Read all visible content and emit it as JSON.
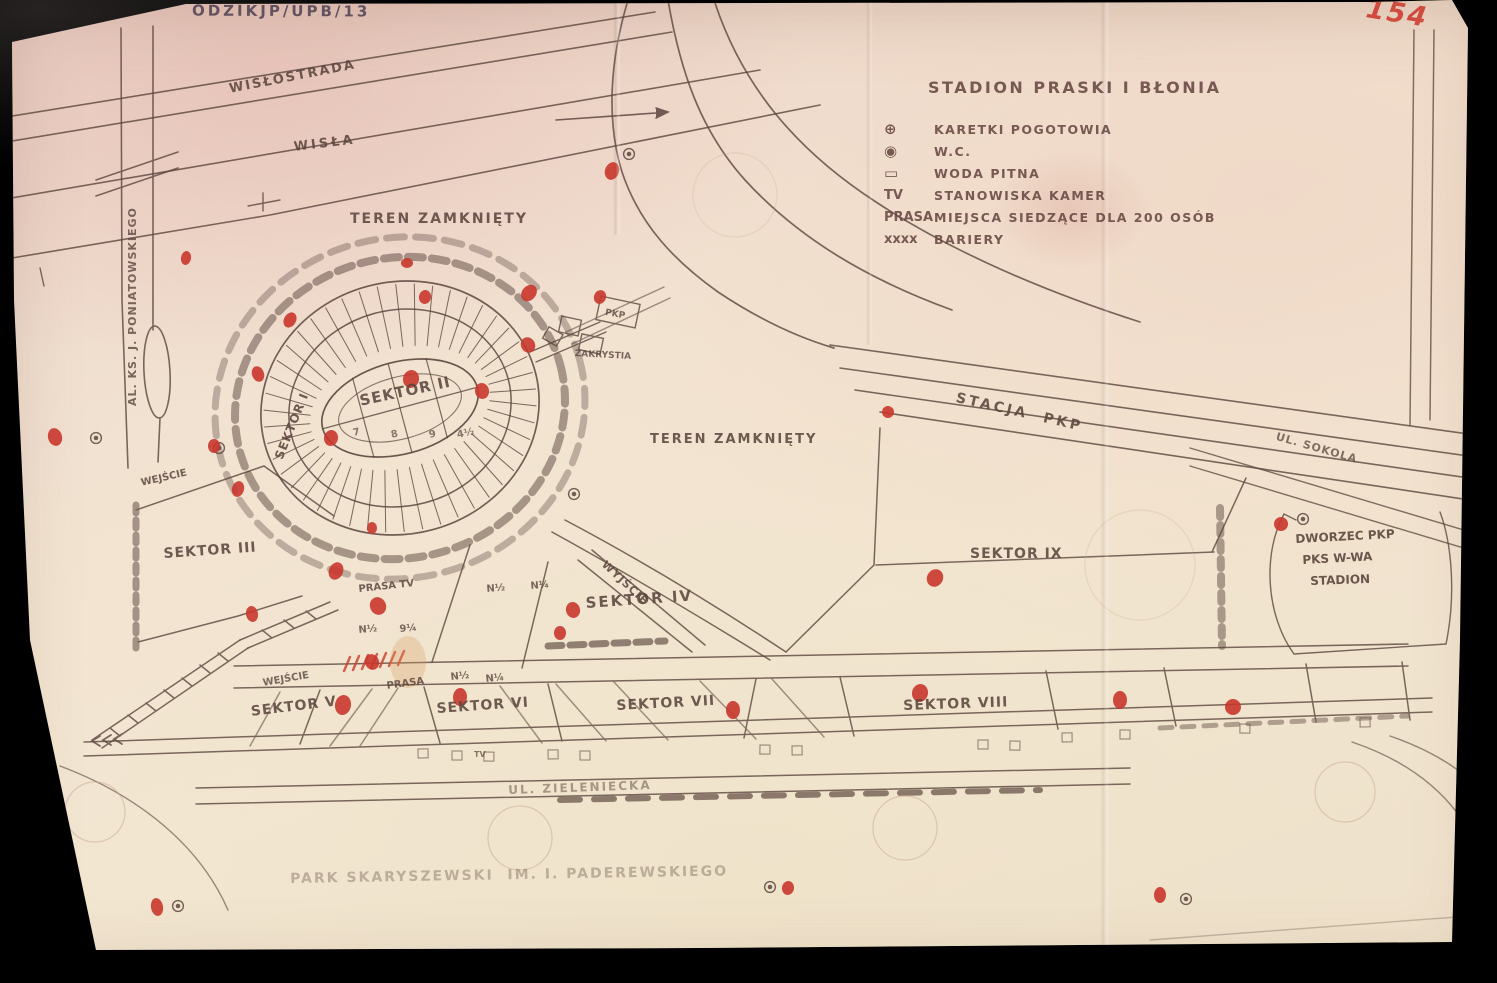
{
  "document": {
    "code": "ODZIKJP/UPB/13",
    "page_number": "154",
    "title": "STADION PRASKI I BŁONIA"
  },
  "legend": {
    "items": [
      {
        "icon": "ambulance-circle-icon",
        "symbol": "⊕",
        "label": "KARETKI POGOTOWIA"
      },
      {
        "icon": "wc-circle-icon",
        "symbol": "◉",
        "label": "W.C."
      },
      {
        "icon": "drinking-water-icon",
        "symbol": "▭",
        "label": "WODA PITNA"
      },
      {
        "icon": "tv-marker",
        "symbol": "TV",
        "label": "STANOWISKA KAMER"
      },
      {
        "icon": "press-marker",
        "symbol": "PRASA",
        "label": "MIEJSCA SIEDZĄCE DLA 200 OSÓB"
      },
      {
        "icon": "barrier-marker",
        "symbol": "xxxx",
        "label": "BARIERY"
      }
    ]
  },
  "map": {
    "colors": {
      "paper": "#f0e1d0",
      "ink": "#5c463e",
      "red": "#c9362c"
    },
    "labels": [
      {
        "name": "wislostrada",
        "text": "WISŁOSTRADA",
        "x": 228,
        "y": 82,
        "fs": 13,
        "rot": -11,
        "ls": 2
      },
      {
        "name": "wisla",
        "text": "WISŁA",
        "x": 293,
        "y": 140,
        "fs": 13,
        "rot": -7,
        "ls": 3
      },
      {
        "name": "teren-zamkniety-nw",
        "text": "TEREN ZAMKNIĘTY",
        "x": 350,
        "y": 211,
        "fs": 14,
        "rot": 0,
        "ls": 2
      },
      {
        "name": "teren-zamkniety-e",
        "text": "TEREN ZAMKNIĘTY",
        "x": 650,
        "y": 432,
        "fs": 13,
        "rot": 0,
        "ls": 2
      },
      {
        "name": "sektor-i",
        "text": "SEKTOR I",
        "x": 272,
        "y": 456,
        "fs": 12,
        "rot": -68,
        "ls": 1
      },
      {
        "name": "sektor-ii",
        "text": "SEKTOR II",
        "x": 358,
        "y": 392,
        "fs": 15,
        "rot": -12,
        "ls": 1
      },
      {
        "name": "sektor-iii",
        "text": "SEKTOR III",
        "x": 163,
        "y": 546,
        "fs": 14,
        "rot": -4,
        "ls": 1
      },
      {
        "name": "sektor-iv",
        "text": "SEKTOR IV",
        "x": 585,
        "y": 594,
        "fs": 15,
        "rot": -4,
        "ls": 2
      },
      {
        "name": "sektor-v",
        "text": "SEKTOR V",
        "x": 250,
        "y": 704,
        "fs": 14,
        "rot": -7,
        "ls": 1
      },
      {
        "name": "sektor-vi",
        "text": "SEKTOR VI",
        "x": 436,
        "y": 701,
        "fs": 14,
        "rot": -4,
        "ls": 1
      },
      {
        "name": "sektor-vii",
        "text": "SEKTOR VII",
        "x": 616,
        "y": 698,
        "fs": 14,
        "rot": -3,
        "ls": 1
      },
      {
        "name": "sektor-viii",
        "text": "SEKTOR VIII",
        "x": 903,
        "y": 698,
        "fs": 14,
        "rot": -2,
        "ls": 1
      },
      {
        "name": "sektor-ix",
        "text": "SEKTOR IX",
        "x": 970,
        "y": 546,
        "fs": 14,
        "rot": 0,
        "ls": 1
      },
      {
        "name": "stacja-pkp",
        "text": "STACJA  PKP",
        "x": 958,
        "y": 390,
        "fs": 14,
        "rot": 13,
        "ls": 3
      },
      {
        "name": "ul-sokola",
        "text": "UL. SOKOLA",
        "x": 1278,
        "y": 430,
        "fs": 11,
        "rot": 16,
        "ls": 1,
        "op": 0.75
      },
      {
        "name": "al-ks-j-poniatowskiego",
        "text": "AL. KS. J. PONIATOWSKIEGO",
        "x": 126,
        "y": 406,
        "fs": 11,
        "rot": -90,
        "ls": 1,
        "op": 0.8
      },
      {
        "name": "wejscie-west",
        "text": "WEJŚCIE",
        "x": 140,
        "y": 478,
        "fs": 10,
        "rot": -13,
        "op": 0.85
      },
      {
        "name": "wyjscie",
        "text": "WYJŚCIE",
        "x": 608,
        "y": 558,
        "fs": 11,
        "rot": 43,
        "ls": 1,
        "op": 0.85
      },
      {
        "name": "wejscie-southwest",
        "text": "WEJŚCIE",
        "x": 262,
        "y": 678,
        "fs": 10,
        "rot": -10,
        "op": 0.8
      },
      {
        "name": "prasa-tv",
        "text": "PRASA TV",
        "x": 358,
        "y": 584,
        "fs": 10,
        "rot": -6,
        "op": 0.85
      },
      {
        "name": "prasa-southwest",
        "text": "PRASA",
        "x": 386,
        "y": 681,
        "fs": 10,
        "rot": -8,
        "op": 0.85
      },
      {
        "name": "zakrystia",
        "text": "ZAKRYSTIA",
        "x": 575,
        "y": 349,
        "fs": 9,
        "rot": 3,
        "op": 0.8
      },
      {
        "name": "pkp-box",
        "text": "PKP",
        "x": 606,
        "y": 308,
        "fs": 9,
        "rot": 10,
        "op": 0.8
      },
      {
        "name": "ul-zieleniecka",
        "text": "UL. ZIELENIECKA",
        "x": 508,
        "y": 783,
        "fs": 12,
        "rot": -2,
        "ls": 2,
        "op": 0.5
      },
      {
        "name": "park-skaryszewski",
        "text": "PARK SKARYSZEWSKI  IM. I. PADEREWSKIEGO",
        "x": 290,
        "y": 871,
        "fs": 14,
        "rot": -1,
        "ls": 2,
        "op": 0.35
      },
      {
        "name": "dworzec-pkp-line1",
        "text": "DWORZEC PKP",
        "x": 1295,
        "y": 532,
        "fs": 12,
        "rot": -3,
        "op": 0.9
      },
      {
        "name": "dworzec-pkp-line2",
        "text": "PKS W-WA",
        "x": 1302,
        "y": 553,
        "fs": 12,
        "rot": -3,
        "op": 0.9
      },
      {
        "name": "dworzec-pkp-line3",
        "text": "STADION",
        "x": 1310,
        "y": 574,
        "fs": 12,
        "rot": -2,
        "op": 0.9
      },
      {
        "name": "mark-n-half-1",
        "text": "N½",
        "x": 486,
        "y": 584,
        "fs": 10,
        "rot": -5,
        "op": 0.8
      },
      {
        "name": "mark-n-quarter-1",
        "text": "N¼",
        "x": 530,
        "y": 581,
        "fs": 10,
        "rot": -5,
        "op": 0.8
      },
      {
        "name": "mark-n-half-2",
        "text": "N½",
        "x": 358,
        "y": 625,
        "fs": 10,
        "rot": -5,
        "op": 0.8
      },
      {
        "name": "mark-9-quarter",
        "text": "9¼",
        "x": 399,
        "y": 624,
        "fs": 10,
        "rot": -5,
        "op": 0.8
      },
      {
        "name": "mark-n-half-3",
        "text": "N½",
        "x": 450,
        "y": 672,
        "fs": 10,
        "rot": -6,
        "op": 0.8
      },
      {
        "name": "mark-n-quarter-2",
        "text": "N¼",
        "x": 485,
        "y": 674,
        "fs": 10,
        "rot": -6,
        "op": 0.8
      },
      {
        "name": "field-number-7",
        "text": "7",
        "x": 352,
        "y": 428,
        "fs": 10,
        "rot": -12,
        "op": 0.7
      },
      {
        "name": "field-number-8",
        "text": "8",
        "x": 390,
        "y": 430,
        "fs": 10,
        "rot": -12,
        "op": 0.7
      },
      {
        "name": "field-number-9",
        "text": "9",
        "x": 428,
        "y": 430,
        "fs": 10,
        "rot": -12,
        "op": 0.7
      },
      {
        "name": "field-number-4half",
        "text": "4½",
        "x": 456,
        "y": 430,
        "fs": 10,
        "rot": -12,
        "op": 0.7
      },
      {
        "name": "tv-box",
        "text": "TV",
        "x": 474,
        "y": 750,
        "fs": 8,
        "rot": 0,
        "op": 0.7
      }
    ],
    "red_marks": [
      [
        612,
        171,
        7,
        9,
        20
      ],
      [
        186,
        258,
        5,
        7,
        10
      ],
      [
        55,
        437,
        7,
        9,
        -15
      ],
      [
        238,
        489,
        6,
        8,
        15
      ],
      [
        214,
        446,
        6,
        7,
        0
      ],
      [
        290,
        320,
        6,
        8,
        30
      ],
      [
        258,
        374,
        6,
        8,
        -20
      ],
      [
        331,
        438,
        7,
        8,
        10
      ],
      [
        411,
        379,
        8,
        9,
        15
      ],
      [
        482,
        391,
        8,
        7,
        80
      ],
      [
        529,
        293,
        7,
        9,
        40
      ],
      [
        425,
        297,
        6,
        7,
        10
      ],
      [
        407,
        263,
        6,
        5,
        0
      ],
      [
        600,
        297,
        6,
        7,
        20
      ],
      [
        528,
        345,
        7,
        8,
        -30
      ],
      [
        372,
        528,
        5,
        6,
        0
      ],
      [
        336,
        571,
        7,
        9,
        25
      ],
      [
        252,
        614,
        6,
        8,
        -10
      ],
      [
        372,
        662,
        7,
        8,
        -20
      ],
      [
        343,
        705,
        8,
        10,
        10
      ],
      [
        460,
        697,
        7,
        9,
        5
      ],
      [
        733,
        710,
        7,
        9,
        0
      ],
      [
        920,
        693,
        8,
        9,
        15
      ],
      [
        1120,
        700,
        7,
        9,
        0
      ],
      [
        1233,
        707,
        8,
        8,
        0
      ],
      [
        1281,
        524,
        7,
        7,
        45
      ],
      [
        888,
        412,
        6,
        6,
        0
      ],
      [
        935,
        578,
        8,
        9,
        30
      ],
      [
        573,
        610,
        7,
        8,
        -15
      ],
      [
        560,
        633,
        6,
        7,
        0
      ],
      [
        378,
        606,
        8,
        9,
        -25
      ],
      [
        40,
        771,
        6,
        8,
        0
      ],
      [
        157,
        907,
        6,
        9,
        -10
      ],
      [
        788,
        888,
        6,
        7,
        10
      ],
      [
        1160,
        895,
        6,
        8,
        0
      ],
      [
        1466,
        860,
        5,
        7,
        0
      ]
    ],
    "facility_markers": [
      [
        629,
        154
      ],
      [
        96,
        438
      ],
      [
        219,
        448
      ],
      [
        574,
        494
      ],
      [
        1303,
        519
      ],
      [
        770,
        887
      ],
      [
        1186,
        899
      ],
      [
        178,
        906
      ]
    ]
  }
}
